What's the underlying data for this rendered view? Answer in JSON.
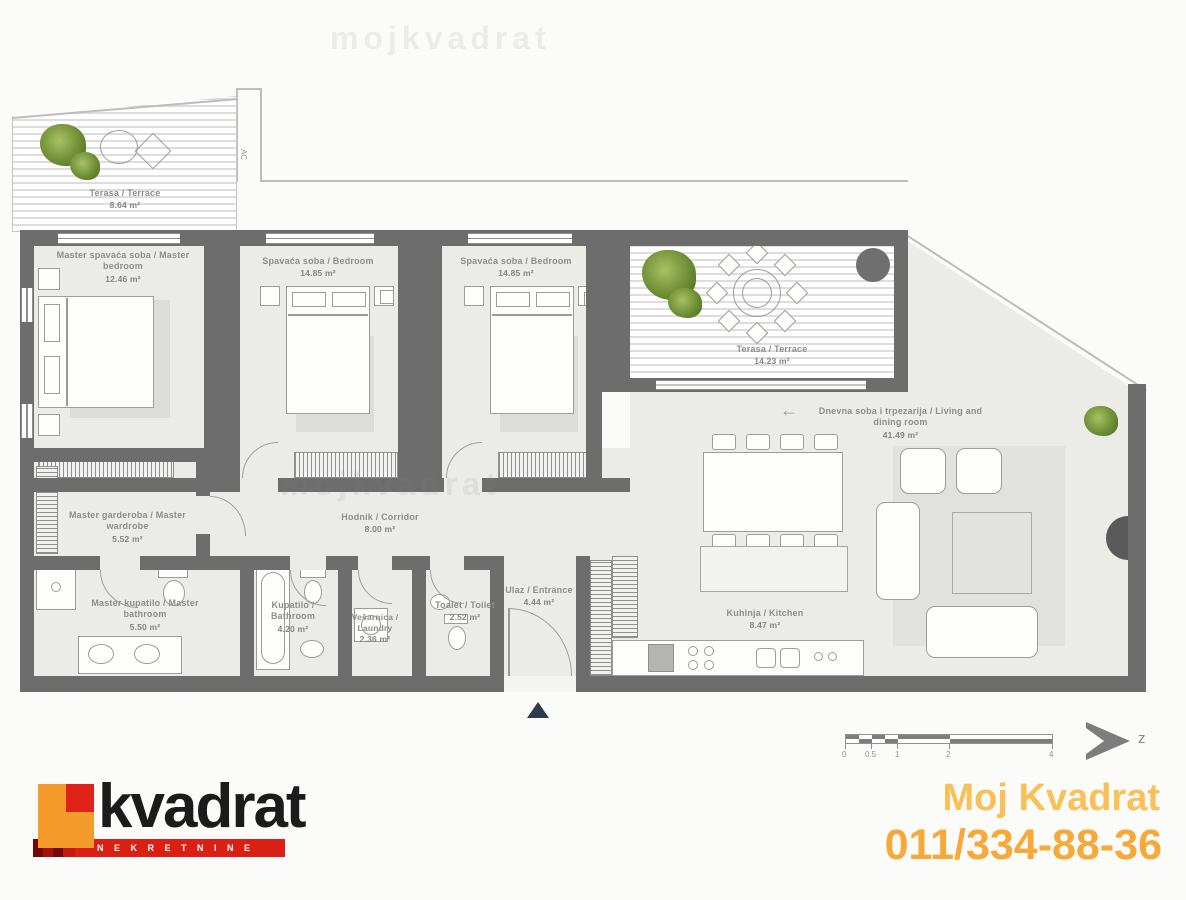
{
  "rooms": [
    {
      "name": "Terasa / Terrace",
      "area": "8.64 m²"
    },
    {
      "name": "Master spavaća soba / Master bedroom",
      "area": "12.46 m²"
    },
    {
      "name": "Spavaća soba / Bedroom",
      "area": "14.85 m²"
    },
    {
      "name": "Spavaća soba / Bedroom",
      "area": "14.85 m²"
    },
    {
      "name": "Terasa / Terrace",
      "area": "14.23 m²"
    },
    {
      "name": "Dnevna soba i trpezarija / Living and dining room",
      "area": "41.49 m²"
    },
    {
      "name": "Master garderoba / Master wardrobe",
      "area": "5.52 m²"
    },
    {
      "name": "Hodnik / Corridor",
      "area": "8.00 m²"
    },
    {
      "name": "Master kupatilo / Master bathroom",
      "area": "5.50 m²"
    },
    {
      "name": "Kupatilo / Bathroom",
      "area": "4.20 m²"
    },
    {
      "name": "Vešarnica / Laundry",
      "area": "2.36 m²"
    },
    {
      "name": "Toalet / Toilet",
      "area": "2.52 m²"
    },
    {
      "name": "Ulaz / Entrance",
      "area": "4.44 m²"
    },
    {
      "name": "Kuhinja / Kitchen",
      "area": "8.47 m²"
    }
  ],
  "plan": {
    "ac_label": "AC",
    "north_label": "z",
    "arrow": "←"
  },
  "scalebar": {
    "ticks": [
      "0",
      "0.5",
      "1",
      "2",
      "4"
    ]
  },
  "watermark": {
    "text": "mojkvadrat"
  },
  "branding": {
    "logo_text": "kvadrat",
    "logo_tagline": "NEKRETNINE",
    "agency_name": "Moj Kvadrat",
    "agency_phone": "011/334-88-36",
    "accent_orange": "#f49b2b",
    "accent_red": "#dc1f15",
    "contact_orange": "#f6a838"
  }
}
